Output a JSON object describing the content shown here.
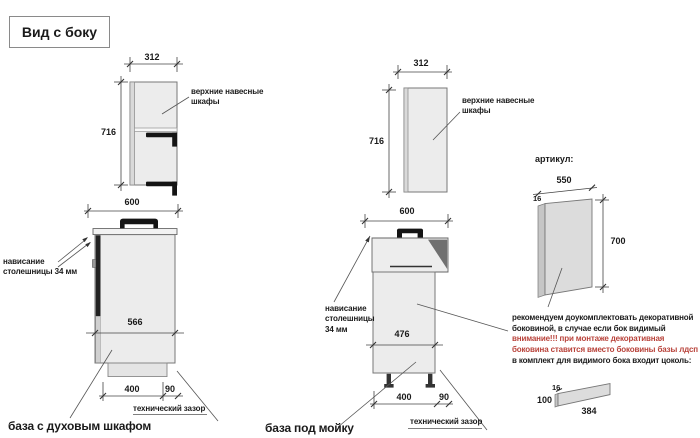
{
  "title": "Вид с боку",
  "colors": {
    "warning_red": "#b8423a",
    "drawing_line": "#555555",
    "cabinet_fill": "#ececec",
    "handle_black": "#141414"
  },
  "oven_group": {
    "upper": {
      "width": "312",
      "height": "716",
      "note": [
        "верхние навесные",
        "шкафы"
      ]
    },
    "base": {
      "top_width": "600",
      "overhang_note": [
        "нависание",
        "столешницы 34 мм"
      ],
      "inner_depth": "566",
      "plinth_width": "400",
      "gap_width": "90",
      "gap_note": "технический зазор",
      "caption": "база с духовым шкафом"
    }
  },
  "sink_group": {
    "upper": {
      "width": "312",
      "height": "716",
      "note": [
        "верхние навесные",
        "шкафы"
      ]
    },
    "base": {
      "top_width": "600",
      "overhang_note": [
        "нависание",
        "столешницы",
        "34 мм"
      ],
      "inner_depth": "476",
      "plinth_width": "400",
      "gap_width": "90",
      "gap_note": "технический зазор",
      "caption": "база под мойку"
    }
  },
  "panel_group": {
    "heading": "артикул:",
    "width": "550",
    "thickness": "16",
    "height": "700",
    "note": [
      "рекомендуем доукомплектовать декоративной",
      "боковиной, в случае если бок видимый"
    ],
    "warning": [
      "внимание!!! при монтаже декоративная",
      "боковина ставится вместо боковины базы лдсп"
    ],
    "note2": "в комплект для видимого бока входит цоколь:",
    "plinth": {
      "thickness": "16",
      "height": "100",
      "length": "384"
    }
  }
}
